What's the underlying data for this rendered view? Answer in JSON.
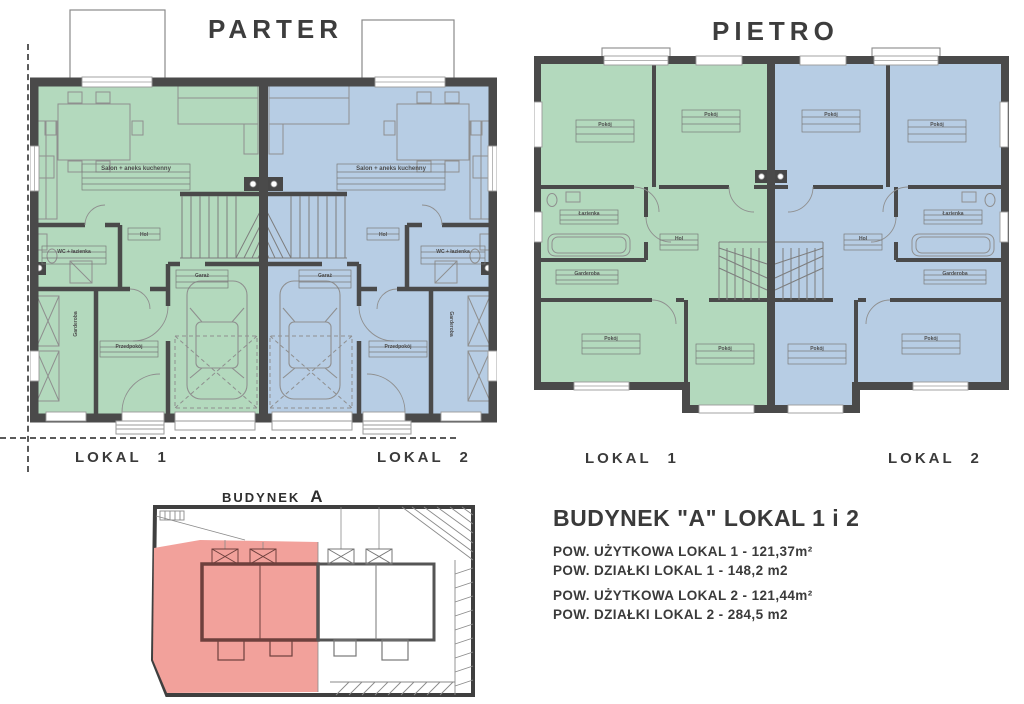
{
  "titles": {
    "parter": "PARTER",
    "pietro": "PIETRO"
  },
  "floor_labels": {
    "parter_lokal1": "LOKAL 1",
    "parter_lokal2": "LOKAL 2",
    "pietro_lokal1": "LOKAL 1",
    "pietro_lokal2": "LOKAL 2"
  },
  "site_plan": {
    "building_word": "BUDYNEK",
    "building_letter": "A"
  },
  "info": {
    "title": "BUDYNEK \"A\" LOKAL 1 i 2",
    "lines": [
      "POW. UŻYTKOWA LOKAL 1 - 121,37m²",
      "POW. DZIAŁKI LOKAL 1 - 148,2 m2",
      "POW. UŻYTKOWA LOKAL 2 - 121,44m²",
      "POW. DZIAŁKI LOKAL 2 - 284,5 m2"
    ]
  },
  "rooms": {
    "parter": [
      "Salon + aneks kuchenny",
      "WC + łazienka",
      "Garderoba",
      "Przedpokój",
      "Hol",
      "Garaż"
    ],
    "pietro": [
      "Pokój",
      "Pokój",
      "Łazienka",
      "Garderoba",
      "Hol",
      "Pokój",
      "Pokój"
    ]
  },
  "colors": {
    "lokal1_fill": "#b3d9bd",
    "lokal2_fill": "#b7cde4",
    "wall": "#4a4a4a",
    "site_highlight": "#f2a19b",
    "text": "#3c3c3c"
  }
}
